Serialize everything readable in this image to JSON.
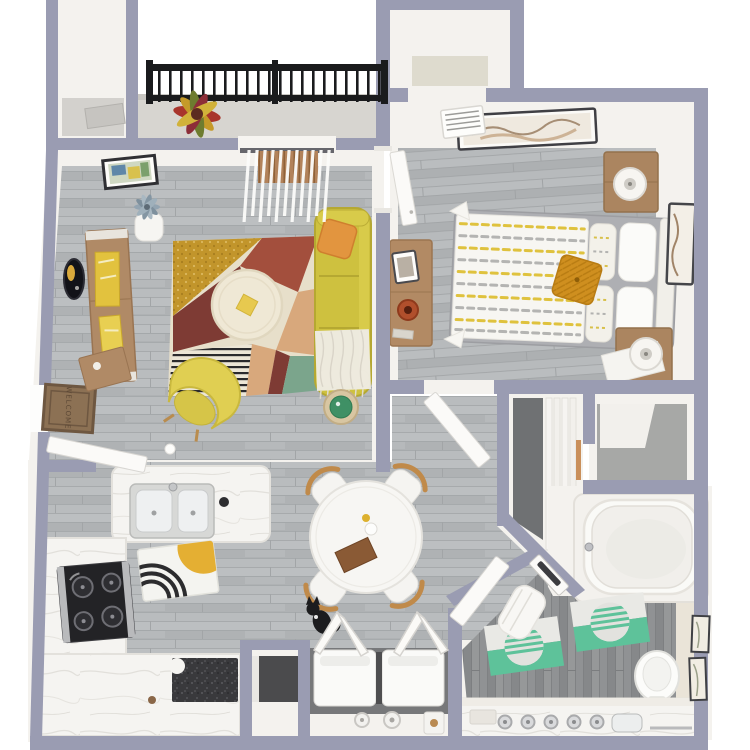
{
  "scene": {
    "description": "Top-down 3D rendered floor plan of a one-bedroom apartment"
  },
  "text": {
    "welcome_mat": "WELCOME"
  },
  "colors": {
    "wall": "#9a9cb2",
    "interior": "#f4f2ee",
    "floor_wood": "#b6b9bb",
    "floor_bath": "#8e9093",
    "floor_closet": "#a7a8a6",
    "balcony_floor": "#d7d5d0",
    "railing": "#1a1b1d",
    "sofa": "#cec13f",
    "armchair": "#e0cf52",
    "pillow_orange": "#e2953f",
    "pillow_mustard": "#cf8f1f",
    "rug_cream": "#e7dfca",
    "rug_mustard": "#c2952b",
    "rug_rust": "#a34f3d",
    "rug_maroon": "#7e3b34",
    "rug_green": "#7ba58c",
    "rug_peach": "#d8a87c",
    "wood_light": "#b08a66",
    "wood_mid": "#ab8560",
    "marble": "#f5f4f1",
    "granite": "#39393c",
    "teal": "#5ec29a",
    "side_table_green": "#3f9065",
    "chair_wood": "#c08a4a",
    "cat_black": "#1c1c1e",
    "blinds_brown": "#b2825a",
    "welcome_mat_brown": "#8c7154",
    "duvet_stripe_yellow": "#dfc23e",
    "duvet_stripe_gray": "#b4b4b2"
  },
  "rooms": [
    {
      "key": "balcony"
    },
    {
      "key": "living-room"
    },
    {
      "key": "bedroom"
    },
    {
      "key": "entry-closet"
    },
    {
      "key": "walk-in-closet"
    },
    {
      "key": "linen-closet"
    },
    {
      "key": "hallway"
    },
    {
      "key": "bathroom"
    },
    {
      "key": "laundry-closet"
    },
    {
      "key": "storage-closet"
    },
    {
      "key": "kitchen"
    },
    {
      "key": "dining-area"
    },
    {
      "key": "entry"
    }
  ],
  "furniture": {
    "living_room": [
      "mustard-sofa",
      "orange-throw-pillow",
      "knit-throw",
      "yellow-armchair",
      "round-coffee-table",
      "geometric-area-rug",
      "rattan-side-table",
      "media-console",
      "framed-wall-art",
      "oval-wall-decor",
      "plant-stand",
      "vertical-blinds-door"
    ],
    "bedroom": [
      "bed-striped-duvet",
      "mustard-accent-pillow",
      "nightstand-with-lamp-top",
      "nightstand-with-lamp-bottom",
      "dresser",
      "picture-frame",
      "vase",
      "framed-art-top-wall",
      "framed-art-right-wall",
      "hvac-vent",
      "open-door"
    ],
    "kitchen": [
      "marble-peninsula",
      "double-basin-sink",
      "black-cooktop-range",
      "granite-counter-section",
      "sun-pattern-mat"
    ],
    "dining_area": [
      "round-white-table",
      "four-wood-back-chairs",
      "black-cat"
    ],
    "bathroom": [
      "bathtub",
      "toilet",
      "vanity-counter",
      "chrome-knobs",
      "teal-bath-mat-1",
      "teal-bath-mat-2",
      "wall-frames",
      "white-towel",
      "mirror-panel-door"
    ],
    "laundry_closet": [
      "washer",
      "dryer",
      "bifold-doors"
    ],
    "balcony": [
      "black-metal-railing",
      "croton-plant"
    ],
    "entry": [
      "welcome-mat",
      "open-entry-door",
      "wall-shelf"
    ]
  }
}
